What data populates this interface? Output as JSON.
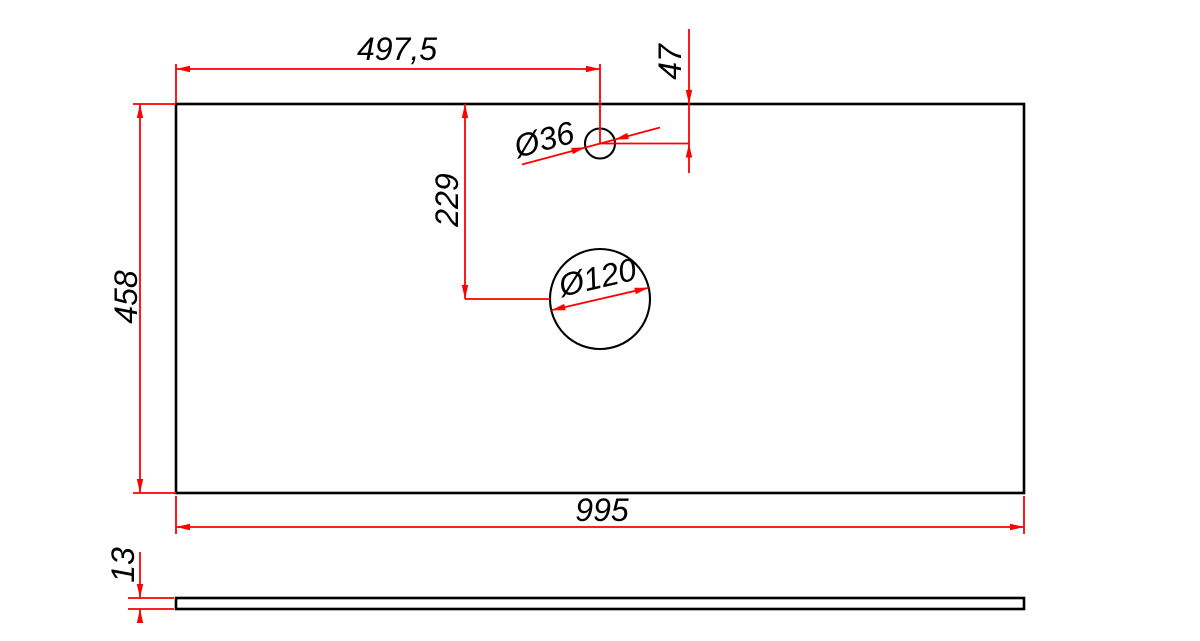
{
  "drawing": {
    "background_color": "#ffffff",
    "outline_color": "#000000",
    "dimension_color": "#fe0000",
    "text_color": "#000000",
    "top_view": {
      "width": "995",
      "height": "458",
      "hole_small": {
        "diameter": "Ø36",
        "offset_from_left": "497,5",
        "offset_from_top": "47"
      },
      "hole_large": {
        "diameter": "Ø120",
        "offset_from_top": "229"
      }
    },
    "side_view": {
      "thickness": "13"
    }
  }
}
